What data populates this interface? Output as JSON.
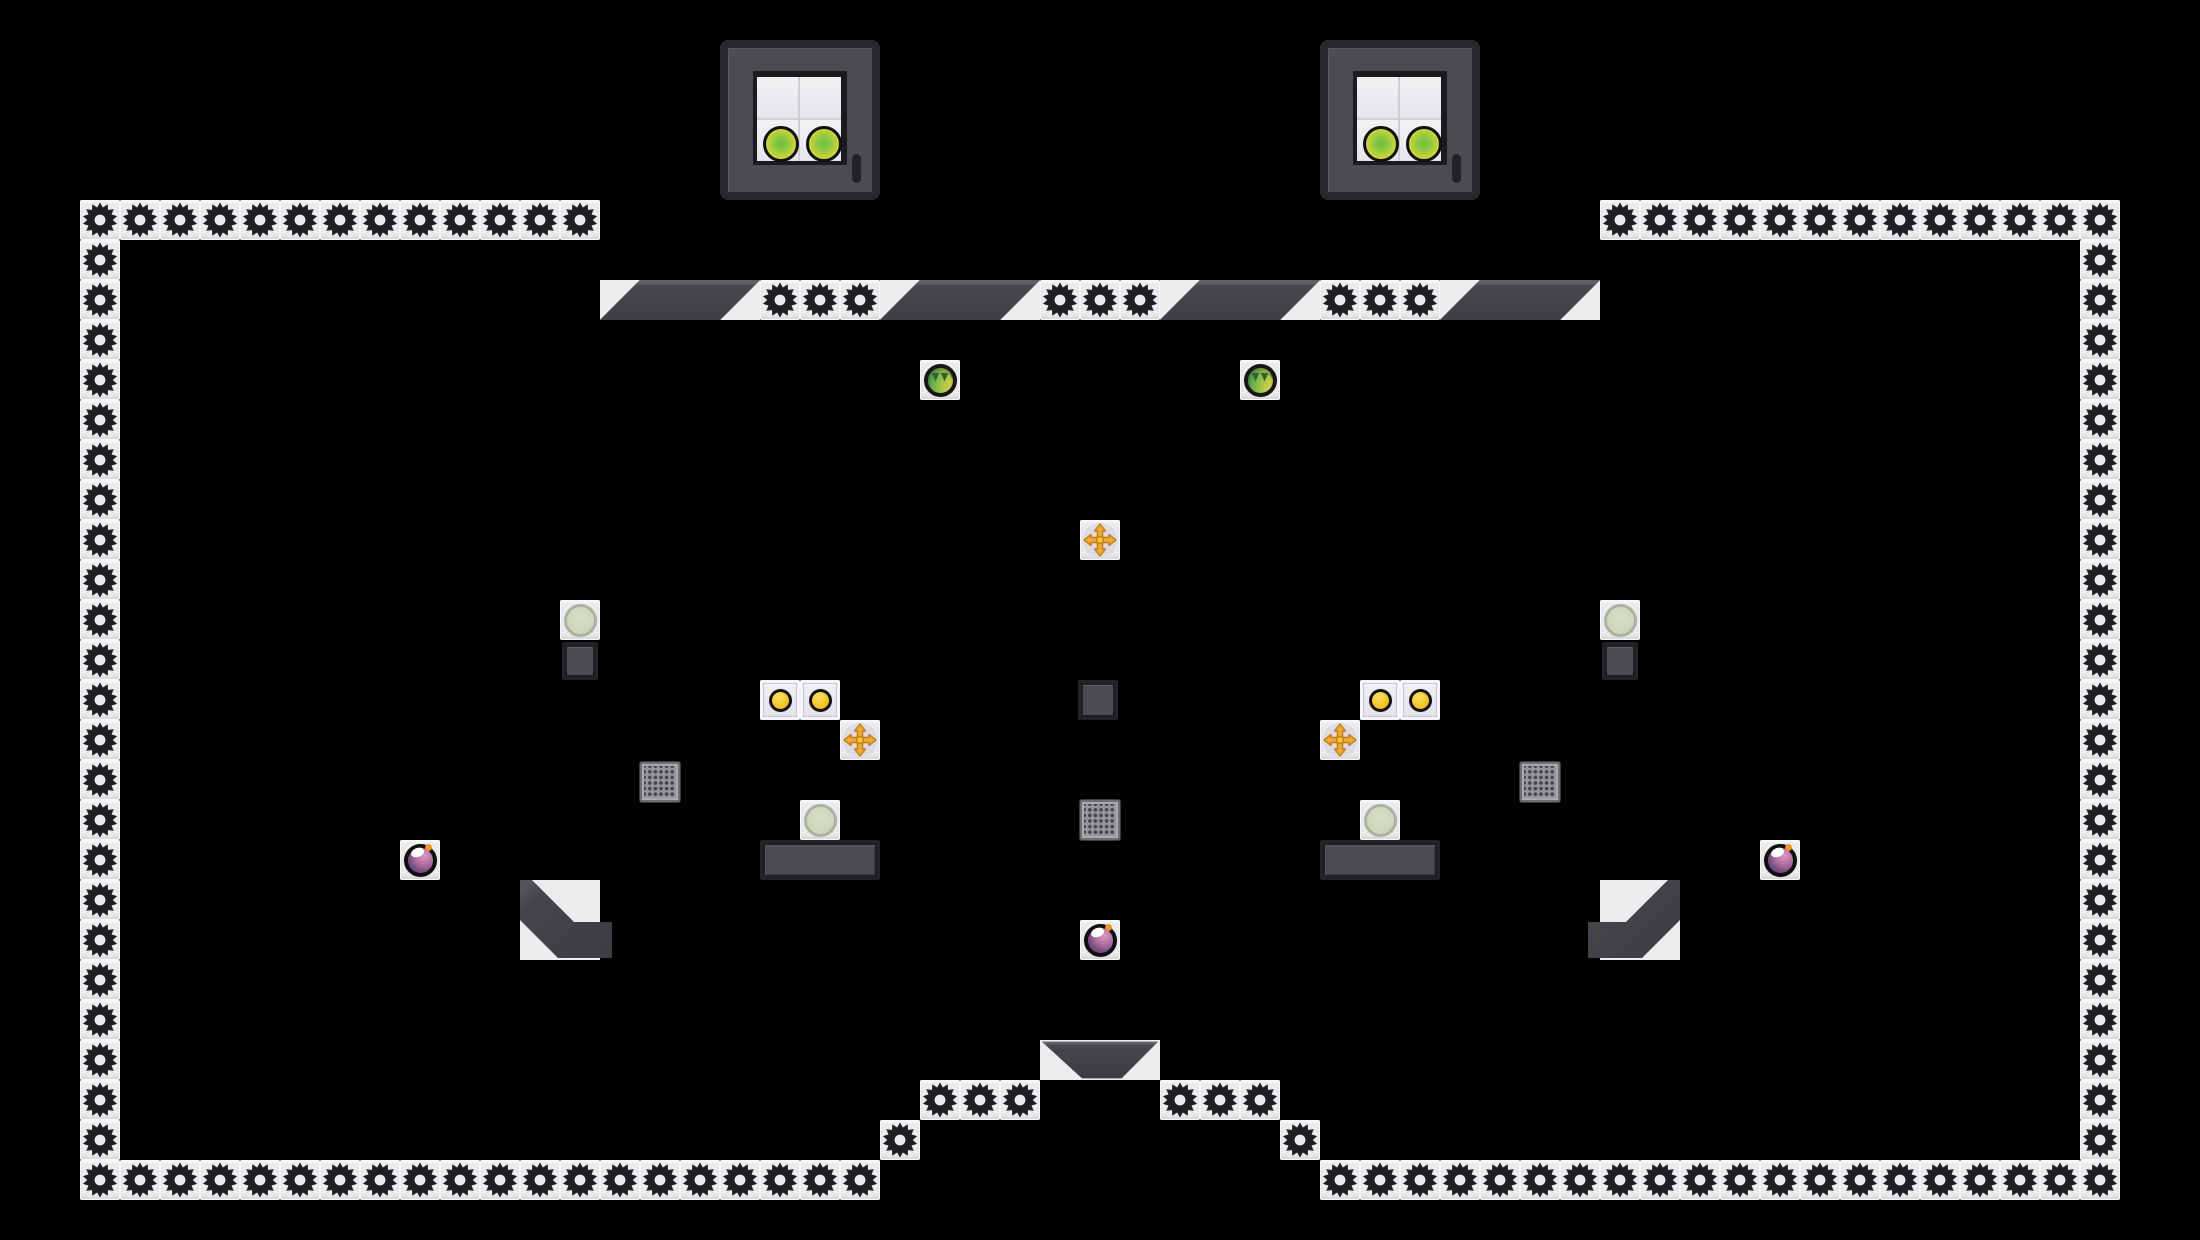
{
  "app": {
    "description": "puzzle platformer level made of gear blocks, spawner boxes, orbs and pickups"
  },
  "canvas": {
    "width": 2200,
    "height": 1240,
    "background": "#000000"
  },
  "palette": {
    "background": "#000000",
    "tile_white": "#ECEBEE",
    "gear_dark": "#1F1F23",
    "block_dark_body": "#4B4B51",
    "block_dark_border": "#232327",
    "block_bevel": "#5E5E66",
    "grate_body": "#96969A",
    "grate_dot": "#46464A",
    "button_yellow": "#F2C12E",
    "arrow_orange": "#F1A73A",
    "green_orb_green": "#4E9E4C",
    "green_orb_yellow": "#DDD545",
    "pale_circle": "#CFD8BF",
    "bomb_purple_light": "#CF8FB4",
    "bomb_purple_dark": "#553A6B",
    "spark_orange": "#EA9530",
    "spawner_orb_green": "#7CC244",
    "spawner_orb_yellow": "#E2DE3A"
  },
  "board": {
    "tile_size": 40,
    "gear_runs": [
      {
        "x": 80,
        "y": 200,
        "dx": 40,
        "dy": 0,
        "count": 13
      },
      {
        "x": 1600,
        "y": 200,
        "dx": 40,
        "dy": 0,
        "count": 13
      },
      {
        "x": 80,
        "y": 240,
        "dx": 0,
        "dy": 40,
        "count": 24
      },
      {
        "x": 2080,
        "y": 240,
        "dx": 0,
        "dy": 40,
        "count": 24
      },
      {
        "x": 120,
        "y": 1160,
        "dx": 40,
        "dy": 0,
        "count": 19
      },
      {
        "x": 1320,
        "y": 1160,
        "dx": 40,
        "dy": 0,
        "count": 19
      },
      {
        "x": 760,
        "y": 280,
        "dx": 40,
        "dy": 0,
        "count": 3
      },
      {
        "x": 1040,
        "y": 280,
        "dx": 40,
        "dy": 0,
        "count": 3
      },
      {
        "x": 1320,
        "y": 280,
        "dx": 40,
        "dy": 0,
        "count": 3
      },
      {
        "x": 920,
        "y": 1080,
        "dx": 40,
        "dy": 0,
        "count": 3
      },
      {
        "x": 1160,
        "y": 1080,
        "dx": 40,
        "dy": 0,
        "count": 3
      },
      {
        "x": 880,
        "y": 1120,
        "dx": 40,
        "dy": 0,
        "count": 1
      },
      {
        "x": 1280,
        "y": 1120,
        "dx": 40,
        "dy": 0,
        "count": 1
      }
    ],
    "ramp_segments": [
      {
        "x": 600,
        "y": 280,
        "w": 160,
        "h": 40
      },
      {
        "x": 880,
        "y": 280,
        "w": 160,
        "h": 40
      },
      {
        "x": 1160,
        "y": 280,
        "w": 160,
        "h": 40
      },
      {
        "x": 1440,
        "y": 280,
        "w": 160,
        "h": 40
      }
    ],
    "dispensers": [
      {
        "x": 720,
        "y": 40,
        "size": 160
      },
      {
        "x": 1320,
        "y": 40,
        "size": 160
      }
    ],
    "platforms": [
      {
        "x": 760,
        "y": 840,
        "w": 120,
        "h": 40
      },
      {
        "x": 1320,
        "y": 840,
        "w": 120,
        "h": 40
      }
    ],
    "crates": [
      {
        "x": 562,
        "y": 642,
        "w": 36,
        "h": 38
      },
      {
        "x": 1602,
        "y": 642,
        "w": 36,
        "h": 38
      },
      {
        "x": 1078,
        "y": 680,
        "w": 40,
        "h": 40
      }
    ],
    "grates": [
      {
        "x": 640,
        "y": 762
      },
      {
        "x": 1520,
        "y": 762
      },
      {
        "x": 1080,
        "y": 800
      }
    ],
    "chutes": [
      {
        "x": 520,
        "y": 880,
        "dir": "exit-right"
      },
      {
        "x": 1588,
        "y": 880,
        "dir": "exit-left"
      }
    ],
    "funnel": {
      "x": 1040,
      "y": 1040,
      "w": 120,
      "h": 40
    },
    "green_orbs": [
      {
        "x": 920,
        "y": 360
      },
      {
        "x": 1240,
        "y": 360
      }
    ],
    "move_pickups": [
      {
        "x": 1080,
        "y": 520
      },
      {
        "x": 840,
        "y": 720
      },
      {
        "x": 1320,
        "y": 720
      }
    ],
    "dot_buttons": [
      {
        "x": 760,
        "y": 680
      },
      {
        "x": 800,
        "y": 680
      },
      {
        "x": 1360,
        "y": 680
      },
      {
        "x": 1400,
        "y": 680
      }
    ],
    "pale_circles": [
      {
        "x": 560,
        "y": 600
      },
      {
        "x": 1600,
        "y": 600
      },
      {
        "x": 800,
        "y": 800
      },
      {
        "x": 1360,
        "y": 800
      }
    ],
    "bombs": [
      {
        "x": 400,
        "y": 840
      },
      {
        "x": 1760,
        "y": 840
      },
      {
        "x": 1080,
        "y": 920
      }
    ]
  }
}
